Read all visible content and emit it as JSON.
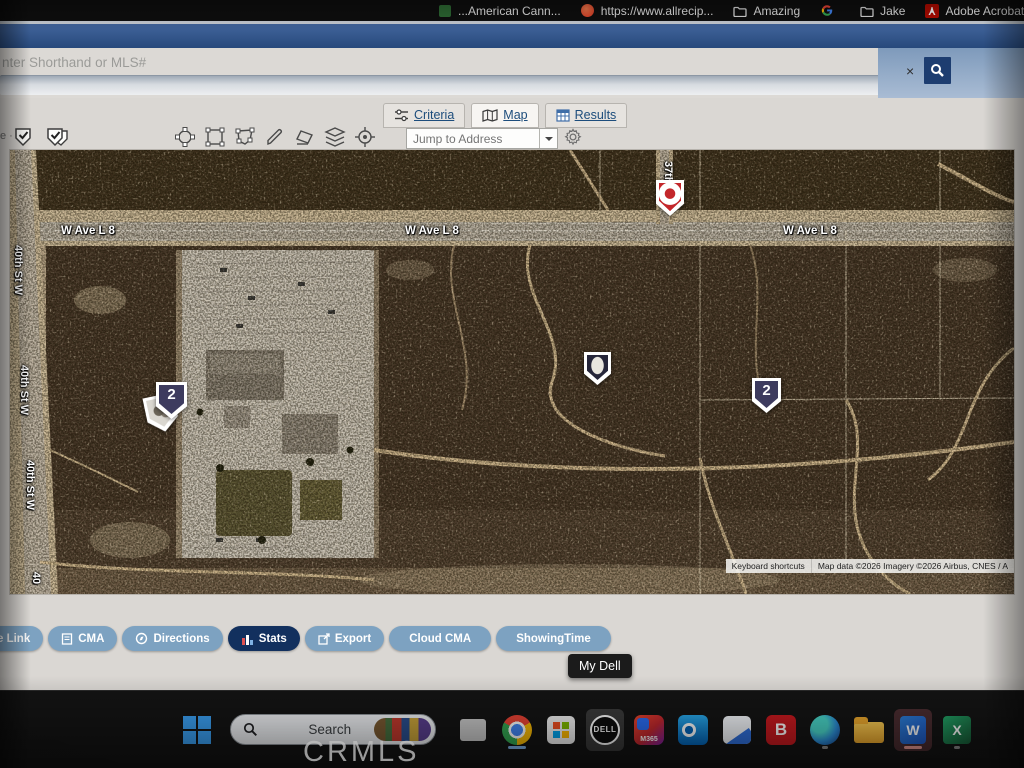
{
  "bookmarks": {
    "items": [
      {
        "label": "...American Cann...",
        "icon": "leaf-icon"
      },
      {
        "label": "https://www.allrecip...",
        "icon": "allrecipes-icon"
      },
      {
        "label": "Amazing",
        "icon": "folder-icon"
      },
      {
        "label": "",
        "icon": "google-g-icon"
      },
      {
        "label": "Jake",
        "icon": "folder-icon"
      },
      {
        "label": "Adobe Acrobat Ho",
        "icon": "acrobat-icon"
      }
    ]
  },
  "search_header": {
    "placeholder": "nter Shorthand or MLS#",
    "clear_label": "×"
  },
  "tabs": {
    "criteria": "Criteria",
    "map": "Map",
    "results": "Results"
  },
  "toolbar": {
    "partial_label": "e ·"
  },
  "map_controls": {
    "jump_to_address": "Jump to Address"
  },
  "map": {
    "avenue_label": "W Ave L 8",
    "street40_label": "40th St W",
    "street40_partial": "40",
    "street37_label": "37th St W",
    "markers": {
      "left_cluster_count": "2",
      "right_cluster_count": "2"
    },
    "attribution": {
      "keyboard_shortcuts": "Keyboard shortcuts",
      "map_data": "Map data ©2026 Imagery ©2026 Airbus, CNES / A"
    }
  },
  "action_bar": {
    "link": "e Link",
    "cma": "CMA",
    "directions": "Directions",
    "stats": "Stats",
    "export": "Export",
    "cloud_cma": "Cloud CMA",
    "showingtime": "ShowingTime"
  },
  "tooltip": {
    "label": "My Dell"
  },
  "taskbar": {
    "search_label": "Search",
    "dell_label": "DELL",
    "m365_label": "M365",
    "bing_label": "B",
    "word_label": "W",
    "excel_label": "X"
  },
  "watermark": {
    "label": "CRMLS"
  },
  "colors": {
    "accent_navy": "#1d3d70",
    "steel_blue": "#7da2c1",
    "marker_navy": "#3d3b5e",
    "marker_red": "#c3272b"
  }
}
